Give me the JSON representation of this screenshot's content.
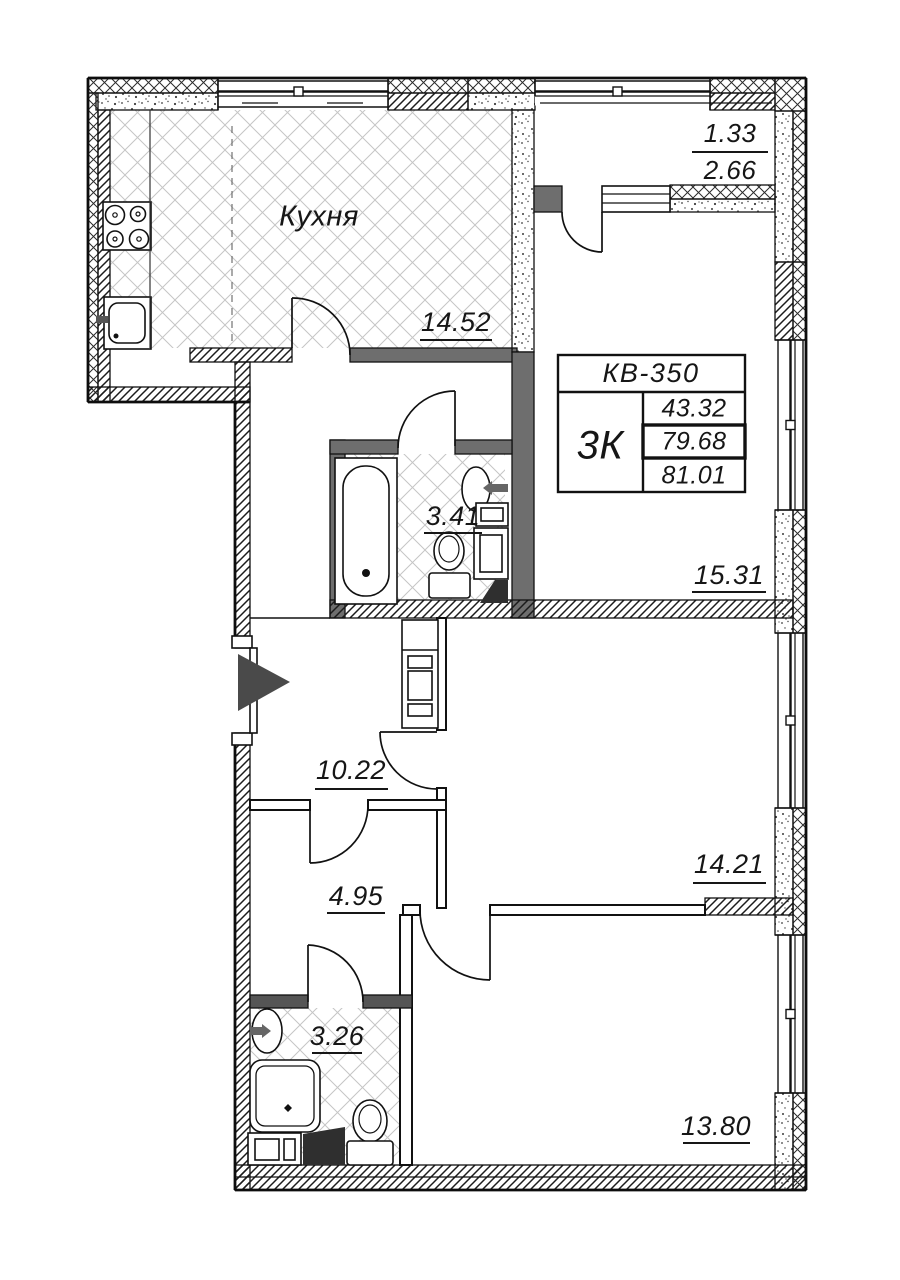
{
  "floor_plan": {
    "title_block": {
      "apartment": "КВ-350",
      "type": "3К",
      "area_living": "43.32",
      "area_total": "79.68",
      "area_total_balcony": "81.01"
    },
    "labels": {
      "kitchen_name": "Кухня",
      "kitchen_area": "14.52",
      "room_top_area": "15.31",
      "room_middle_area": "14.21",
      "room_bottom_area": "13.80",
      "hall_area": "10.22",
      "corridor_area": "4.95",
      "bathroom_area": "3.41",
      "shower_room_area": "3.26",
      "balcony_reduced_area": "1.33",
      "balcony_full_area": "2.66"
    },
    "colors": {
      "line": "#111111",
      "wall_fill_gray": "#6e6e6e",
      "wall_fill_dark": "#555555",
      "floor_hatch": "#c5c5c5",
      "arrow_fill": "#4a4a4a"
    }
  }
}
